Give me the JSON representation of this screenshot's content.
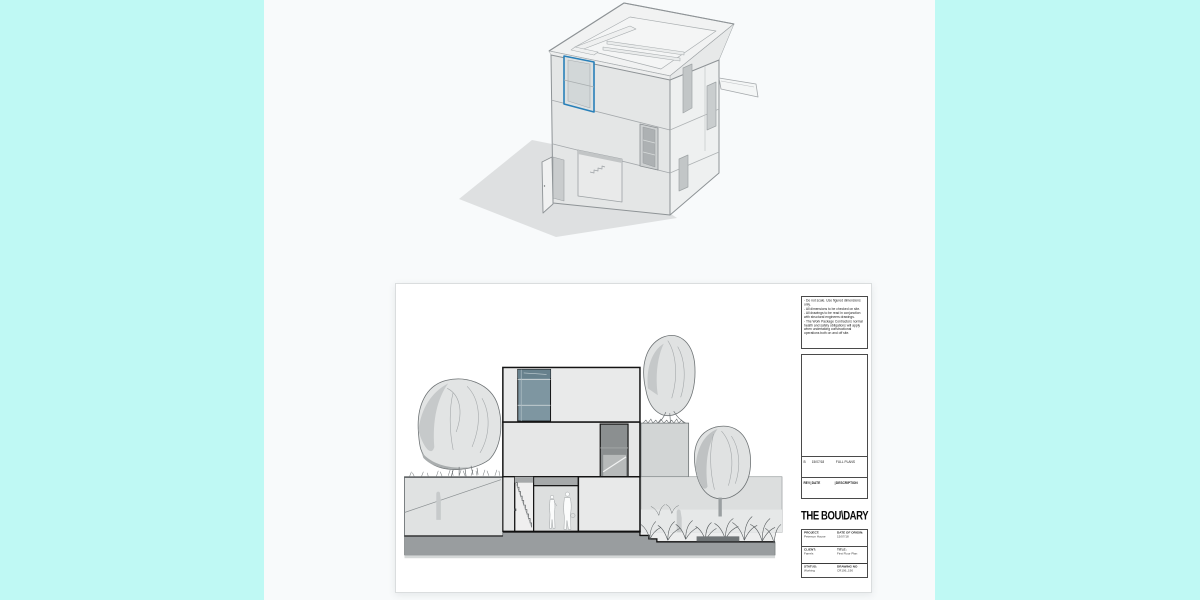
{
  "canvas": {
    "background": "#F8FAFB",
    "panel_color": "#BFF9F4"
  },
  "viewport": {
    "model_name": "axonometric-house-model",
    "selection_color": "#2980B9"
  },
  "sheet": {
    "sep": "|",
    "notes": [
      "- Do not scale. Use figured dimensions only.",
      "- All dimensions to be checked on site.",
      "- All drawings to be read in conjunction with structural engineers drawings.",
      "- The Work Package Contractors normal health and safety obligations will apply when undertaking constructional operations both on and off site."
    ],
    "revision_row": {
      "rev": "B",
      "date": "15/07/18",
      "description": "FULL PLANS"
    },
    "revision_header": {
      "rev": "REV",
      "date": "DATE",
      "description": "DESCRIPTION"
    },
    "logo_text": "THE BOU\\DARY",
    "title_block": {
      "project_label": "PROJECT:",
      "project_value": "Peterson House",
      "date_of_origin_label": "DATE OF ORIGIN:",
      "date_of_origin_value": "15/07/18",
      "client_label": "CLIENT:",
      "client_value": "Farrels",
      "title_label": "TITLE:",
      "title_value": "First Floor Plan",
      "status_label": "STATUS:",
      "status_value": "Working",
      "drawing_no_label": "DRAWING NO",
      "drawing_no_value": "CR106_190"
    }
  }
}
